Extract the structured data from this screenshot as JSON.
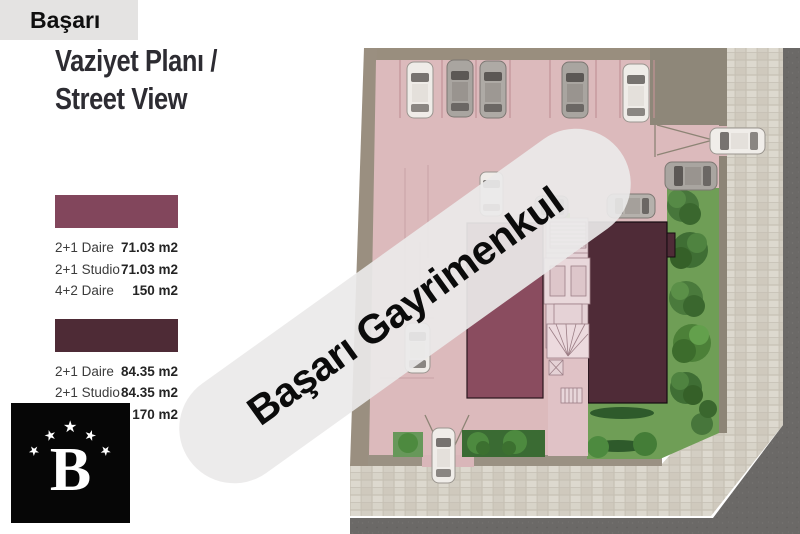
{
  "brand_bar": {
    "label": "Başarı"
  },
  "title": {
    "line1": "Vaziyet Planı /",
    "line2": "Street View"
  },
  "legend": {
    "type1": {
      "color": "#82465C",
      "rows": [
        {
          "label": "2+1 Daire",
          "value": "71.03 m2"
        },
        {
          "label": "2+1 Studio",
          "value": "71.03 m2"
        },
        {
          "label": "4+2 Daire",
          "value": "150 m2"
        }
      ]
    },
    "type2": {
      "color": "#4E2B36",
      "rows": [
        {
          "label": "2+1 Daire",
          "value": "84.35 m2"
        },
        {
          "label": "2+1 Studio",
          "value": "84.35 m2"
        },
        {
          "label": "4+2 Daire",
          "value": "170 m2"
        }
      ]
    }
  },
  "watermark": {
    "text": "Başarı Gayrimenkul"
  },
  "logo": {
    "letter": "B",
    "star": "★",
    "star_count": 5
  },
  "plan": {
    "colors": {
      "ground": "#dcbabc",
      "boundary_wall": "#998e7e",
      "concrete_pad": "#8e8779",
      "sidewalk": "#d7d3c8",
      "road": "#6b6967",
      "grass": "#6f9e56",
      "building_type1": "#8a4c5f",
      "building_type2": "#4f2b37",
      "stair_core": "#e5d2d6"
    }
  }
}
